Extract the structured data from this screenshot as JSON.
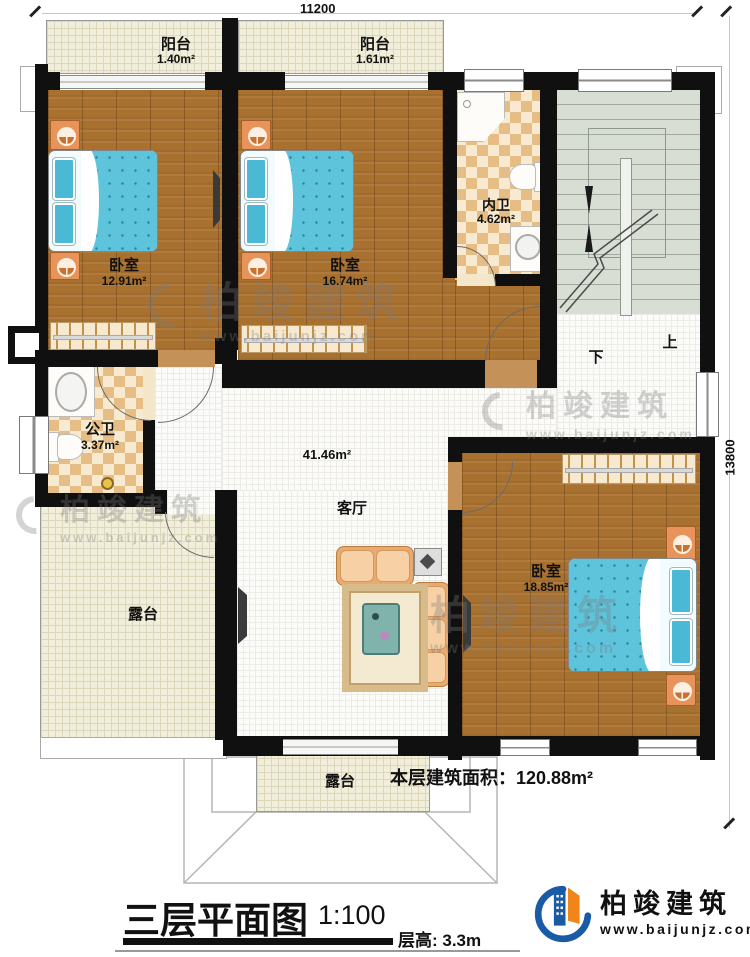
{
  "dimensions": {
    "top": "11200",
    "right": "13800"
  },
  "rooms": {
    "balcony1": {
      "label": "阳台",
      "area": "1.40m²"
    },
    "balcony2": {
      "label": "阳台",
      "area": "1.61m²"
    },
    "bedroom1": {
      "label": "卧室",
      "area": "12.91m²"
    },
    "bedroom2": {
      "label": "卧室",
      "area": "16.74m²"
    },
    "ensuite_bath": {
      "label": "内卫",
      "area": "4.62m²"
    },
    "public_bath": {
      "label": "公卫",
      "area": "3.37m²"
    },
    "living": {
      "label": "客厅",
      "area": "41.46m²"
    },
    "bedroom3": {
      "label": "卧室",
      "area": "18.85m²"
    },
    "terrace_left": {
      "label": "露台"
    },
    "terrace_bottom": {
      "label": "露台"
    }
  },
  "stairs": {
    "up": "上",
    "down": "下"
  },
  "summary": {
    "floor_area": "本层建筑面积：120.88m²"
  },
  "titleblock": {
    "title": "三层平面图",
    "scale": "1:100",
    "floor_height": "层高: 3.3m"
  },
  "brand": {
    "name": "柏竣建筑",
    "url": "www.baijunjz.com"
  },
  "watermark": {
    "name": "柏竣建筑",
    "url": "www.baijunjz.com"
  },
  "colors": {
    "wall": "#101010",
    "wood_floor": "#a9712f",
    "tile_floor": "#fbfbf9",
    "balcony_floor": "#f1eedb",
    "bath_checker": "#e5bd85",
    "stair_floor": "#d8ded4",
    "bed_blue": "#5ec4db",
    "logo_blue": "#1a5ba6",
    "logo_orange": "#f08519"
  }
}
